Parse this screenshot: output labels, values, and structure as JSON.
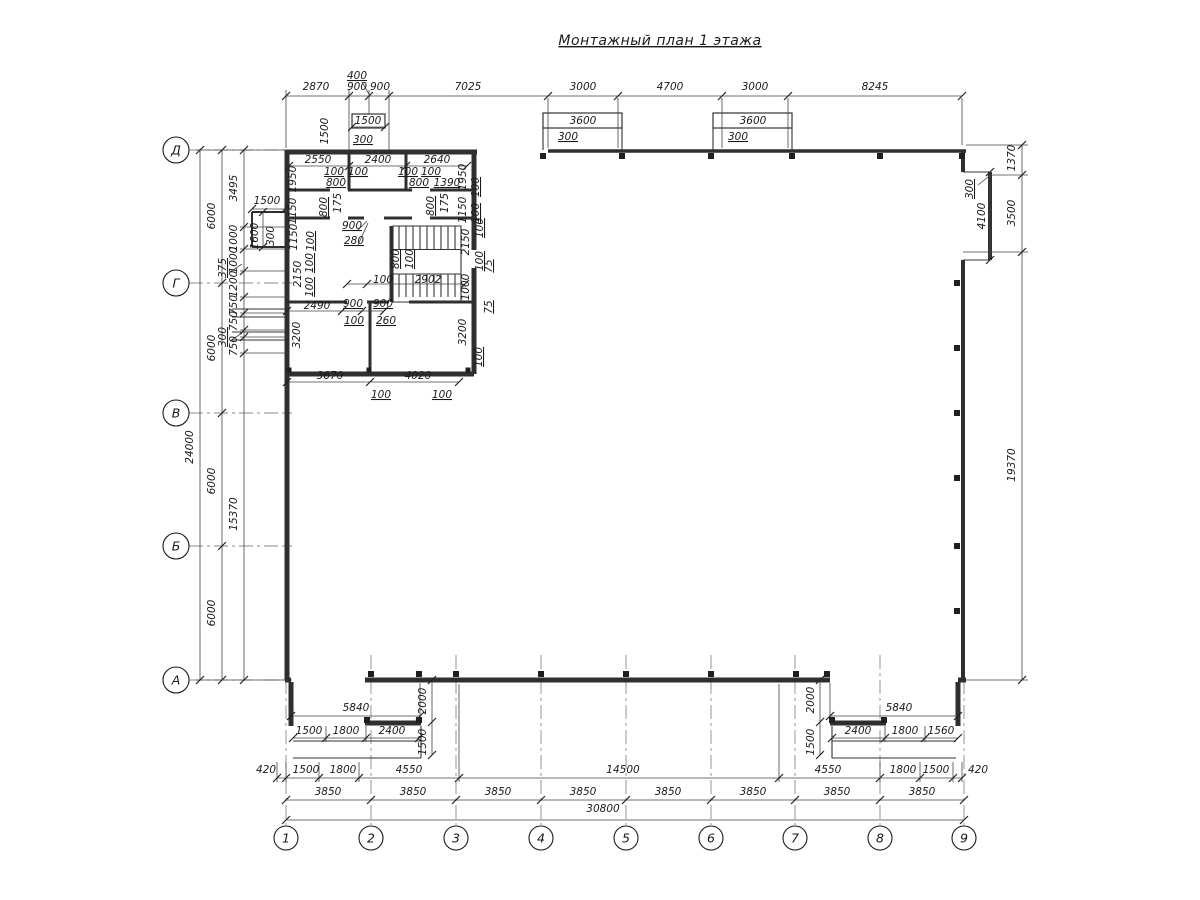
{
  "title": "Монтажный план 1 этажа",
  "axes": {
    "rows": [
      {
        "label": "Д",
        "y": 150
      },
      {
        "label": "Г",
        "y": 283
      },
      {
        "label": "В",
        "y": 413
      },
      {
        "label": "Б",
        "y": 546
      },
      {
        "label": "А",
        "y": 680
      }
    ],
    "cols": [
      {
        "label": "1",
        "x": 286
      },
      {
        "label": "2",
        "x": 371
      },
      {
        "label": "3",
        "x": 456
      },
      {
        "label": "4",
        "x": 541
      },
      {
        "label": "5",
        "x": 626
      },
      {
        "label": "6",
        "x": 711
      },
      {
        "label": "7",
        "x": 795
      },
      {
        "label": "8",
        "x": 880
      },
      {
        "label": "9",
        "x": 964
      }
    ]
  },
  "labels": [
    {
      "t": "2870",
      "x": 316,
      "y": 90
    },
    {
      "t": "900",
      "x": 357,
      "y": 90
    },
    {
      "t": "900",
      "x": 380,
      "y": 90
    },
    {
      "t": "7025",
      "x": 468,
      "y": 90
    },
    {
      "t": "3000",
      "x": 583,
      "y": 90
    },
    {
      "t": "4700",
      "x": 670,
      "y": 90
    },
    {
      "t": "3000",
      "x": 755,
      "y": 90
    },
    {
      "t": "8245",
      "x": 875,
      "y": 90
    },
    {
      "t": "400",
      "x": 357,
      "y": 79,
      "u": 1
    },
    {
      "t": "1500",
      "x": 368,
      "y": 124
    },
    {
      "t": "1500",
      "x": 328,
      "y": 131,
      "r": 1
    },
    {
      "t": "300",
      "x": 363,
      "y": 143,
      "u": 1
    },
    {
      "t": "3600",
      "x": 583,
      "y": 124
    },
    {
      "t": "300",
      "x": 568,
      "y": 140,
      "u": 1
    },
    {
      "t": "3600",
      "x": 753,
      "y": 124
    },
    {
      "t": "300",
      "x": 738,
      "y": 140,
      "u": 1
    },
    {
      "t": "2550",
      "x": 318,
      "y": 163
    },
    {
      "t": "2400",
      "x": 378,
      "y": 163
    },
    {
      "t": "2640",
      "x": 437,
      "y": 163
    },
    {
      "t": "1950",
      "x": 296,
      "y": 179,
      "r": 1
    },
    {
      "t": "1950",
      "x": 466,
      "y": 177,
      "r": 1
    },
    {
      "t": "100",
      "x": 334,
      "y": 175,
      "u": 1
    },
    {
      "t": "100",
      "x": 358,
      "y": 175,
      "u": 1
    },
    {
      "t": "100",
      "x": 408,
      "y": 175,
      "u": 1
    },
    {
      "t": "100",
      "x": 431,
      "y": 175,
      "u": 1
    },
    {
      "t": "800",
      "x": 336,
      "y": 186,
      "u": 1
    },
    {
      "t": "800",
      "x": 419,
      "y": 186,
      "u": 1
    },
    {
      "t": "1390",
      "x": 447,
      "y": 186,
      "u": 1
    },
    {
      "t": "1150",
      "x": 296,
      "y": 211,
      "r": 1
    },
    {
      "t": "1150",
      "x": 466,
      "y": 210,
      "r": 1
    },
    {
      "t": "100",
      "x": 479,
      "y": 187,
      "r": 1,
      "u": 1
    },
    {
      "t": "100",
      "x": 479,
      "y": 213,
      "r": 1,
      "u": 1
    },
    {
      "t": "800",
      "x": 327,
      "y": 207,
      "r": 1,
      "u": 1
    },
    {
      "t": "175",
      "x": 341,
      "y": 203,
      "r": 1
    },
    {
      "t": "800",
      "x": 434,
      "y": 206,
      "r": 1,
      "u": 1
    },
    {
      "t": "175",
      "x": 448,
      "y": 203,
      "r": 1
    },
    {
      "t": "1150",
      "x": 297,
      "y": 237,
      "r": 1
    },
    {
      "t": "100",
      "x": 314,
      "y": 241,
      "r": 1,
      "u": 1
    },
    {
      "t": "900",
      "x": 352,
      "y": 229,
      "u": 1
    },
    {
      "t": "280",
      "x": 354,
      "y": 244,
      "u": 1
    },
    {
      "t": "2150",
      "x": 301,
      "y": 274,
      "r": 1
    },
    {
      "t": "2150",
      "x": 469,
      "y": 242,
      "r": 1
    },
    {
      "t": "100",
      "x": 313,
      "y": 263,
      "r": 1,
      "u": 1
    },
    {
      "t": "100",
      "x": 313,
      "y": 287,
      "r": 1,
      "u": 1
    },
    {
      "t": "100",
      "x": 483,
      "y": 228,
      "r": 1,
      "u": 1
    },
    {
      "t": "100",
      "x": 483,
      "y": 261,
      "r": 1,
      "u": 1
    },
    {
      "t": "800",
      "x": 399,
      "y": 259,
      "r": 1,
      "u": 1
    },
    {
      "t": "100",
      "x": 413,
      "y": 259,
      "r": 1,
      "u": 1
    },
    {
      "t": "100",
      "x": 383,
      "y": 283
    },
    {
      "t": "2902",
      "x": 428,
      "y": 283
    },
    {
      "t": "1000",
      "x": 469,
      "y": 287,
      "r": 1
    },
    {
      "t": "75",
      "x": 492,
      "y": 266,
      "r": 1,
      "u": 1
    },
    {
      "t": "75",
      "x": 492,
      "y": 307,
      "r": 1,
      "u": 1
    },
    {
      "t": "2490",
      "x": 317,
      "y": 309
    },
    {
      "t": "900",
      "x": 353,
      "y": 307,
      "u": 1
    },
    {
      "t": "900",
      "x": 383,
      "y": 307,
      "u": 1
    },
    {
      "t": "100",
      "x": 354,
      "y": 324,
      "u": 1
    },
    {
      "t": "260",
      "x": 386,
      "y": 324,
      "u": 1
    },
    {
      "t": "3200",
      "x": 300,
      "y": 335,
      "r": 1
    },
    {
      "t": "3200",
      "x": 466,
      "y": 332,
      "r": 1
    },
    {
      "t": "100",
      "x": 482,
      "y": 357,
      "r": 1,
      "u": 1
    },
    {
      "t": "3670",
      "x": 330,
      "y": 379
    },
    {
      "t": "4020",
      "x": 418,
      "y": 379
    },
    {
      "t": "100",
      "x": 381,
      "y": 398,
      "u": 1
    },
    {
      "t": "100",
      "x": 442,
      "y": 398,
      "u": 1
    },
    {
      "t": "1500",
      "x": 267,
      "y": 204
    },
    {
      "t": "1600",
      "x": 258,
      "y": 236,
      "r": 1
    },
    {
      "t": "300",
      "x": 274,
      "y": 236,
      "r": 1
    },
    {
      "t": "24000",
      "x": 193,
      "y": 447,
      "r": 1
    },
    {
      "t": "6000",
      "x": 215,
      "y": 216,
      "r": 1
    },
    {
      "t": "6000",
      "x": 215,
      "y": 348,
      "r": 1
    },
    {
      "t": "6000",
      "x": 215,
      "y": 481,
      "r": 1
    },
    {
      "t": "6000",
      "x": 215,
      "y": 613,
      "r": 1
    },
    {
      "t": "3495",
      "x": 237,
      "y": 188,
      "r": 1
    },
    {
      "t": "1000",
      "x": 237,
      "y": 238,
      "r": 1
    },
    {
      "t": "1000",
      "x": 237,
      "y": 260,
      "r": 1
    },
    {
      "t": "1200",
      "x": 237,
      "y": 284,
      "r": 1
    },
    {
      "t": "750",
      "x": 237,
      "y": 305,
      "r": 1
    },
    {
      "t": "750",
      "x": 237,
      "y": 321,
      "r": 1
    },
    {
      "t": "375",
      "x": 226,
      "y": 268,
      "r": 1,
      "u": 1
    },
    {
      "t": "300",
      "x": 226,
      "y": 337,
      "r": 1,
      "u": 1
    },
    {
      "t": "750",
      "x": 237,
      "y": 346,
      "r": 1
    },
    {
      "t": "15370",
      "x": 237,
      "y": 514,
      "r": 1
    },
    {
      "t": "1370",
      "x": 1015,
      "y": 158,
      "r": 1
    },
    {
      "t": "3500",
      "x": 1015,
      "y": 213,
      "r": 1
    },
    {
      "t": "4100",
      "x": 985,
      "y": 216,
      "r": 1
    },
    {
      "t": "300",
      "x": 973,
      "y": 189,
      "r": 1,
      "u": 1
    },
    {
      "t": "19370",
      "x": 1015,
      "y": 465,
      "r": 1
    },
    {
      "t": "5840",
      "x": 356,
      "y": 711
    },
    {
      "t": "2000",
      "x": 426,
      "y": 701,
      "r": 1
    },
    {
      "t": "1500",
      "x": 309,
      "y": 734
    },
    {
      "t": "1800",
      "x": 346,
      "y": 734
    },
    {
      "t": "2400",
      "x": 392,
      "y": 734
    },
    {
      "t": "1500",
      "x": 426,
      "y": 742,
      "r": 1
    },
    {
      "t": "5840",
      "x": 899,
      "y": 711
    },
    {
      "t": "2000",
      "x": 814,
      "y": 700,
      "r": 1
    },
    {
      "t": "2400",
      "x": 858,
      "y": 734
    },
    {
      "t": "1800",
      "x": 905,
      "y": 734
    },
    {
      "t": "1560",
      "x": 941,
      "y": 734
    },
    {
      "t": "1500",
      "x": 814,
      "y": 742,
      "r": 1
    },
    {
      "t": "420",
      "x": 266,
      "y": 773
    },
    {
      "t": "1500",
      "x": 306,
      "y": 773
    },
    {
      "t": "1800",
      "x": 343,
      "y": 773
    },
    {
      "t": "4550",
      "x": 409,
      "y": 773
    },
    {
      "t": "14500",
      "x": 623,
      "y": 773
    },
    {
      "t": "4550",
      "x": 828,
      "y": 773
    },
    {
      "t": "1800",
      "x": 903,
      "y": 773
    },
    {
      "t": "1500",
      "x": 936,
      "y": 773
    },
    {
      "t": "420",
      "x": 978,
      "y": 773
    },
    {
      "t": "3850",
      "x": 328,
      "y": 795
    },
    {
      "t": "3850",
      "x": 413,
      "y": 795
    },
    {
      "t": "3850",
      "x": 498,
      "y": 795
    },
    {
      "t": "3850",
      "x": 583,
      "y": 795
    },
    {
      "t": "3850",
      "x": 668,
      "y": 795
    },
    {
      "t": "3850",
      "x": 753,
      "y": 795
    },
    {
      "t": "3850",
      "x": 837,
      "y": 795
    },
    {
      "t": "3850",
      "x": 922,
      "y": 795
    },
    {
      "t": "30800",
      "x": 603,
      "y": 812
    }
  ]
}
